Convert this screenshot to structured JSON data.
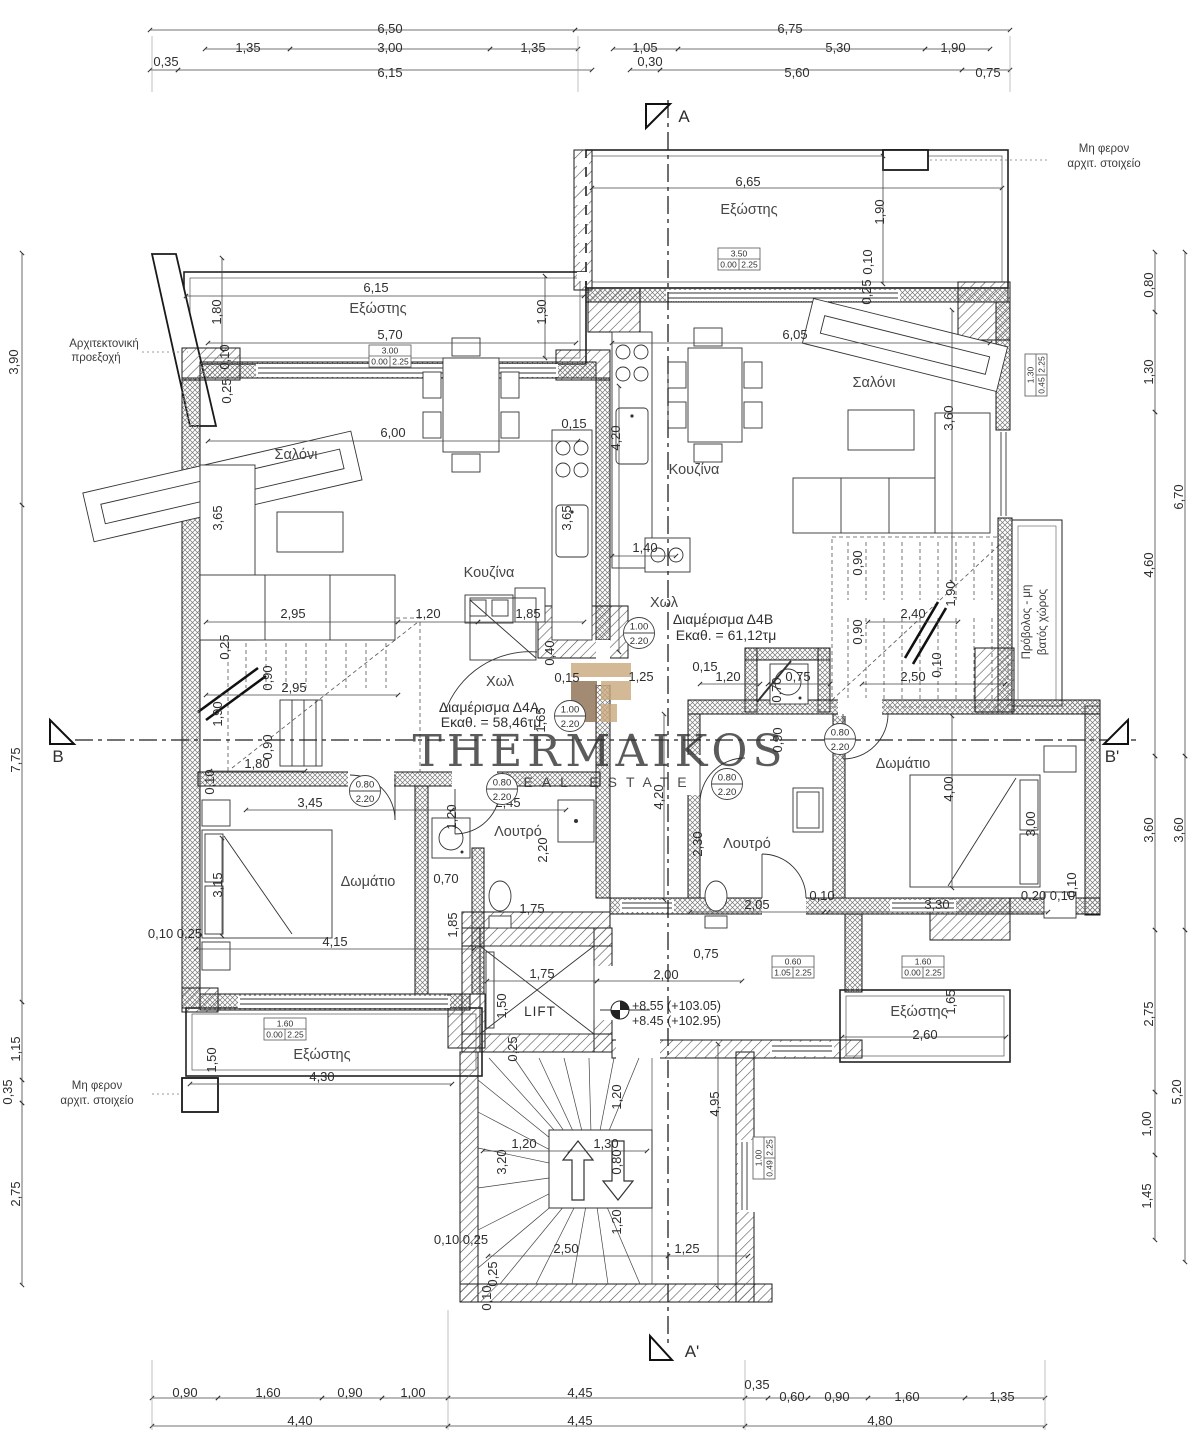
{
  "watermark": {
    "brand": "THERMAIKOS",
    "tagline": "REAL ESTATE"
  },
  "colors": {
    "logo_light": "#c9a87c",
    "logo_dark": "#8d6e50",
    "watermark_text": "#9c9c9c"
  },
  "apartments": [
    {
      "label": "Διαμέρισμα Δ4Α",
      "area": "Εκαθ. = 58,46τμ"
    },
    {
      "label": "Διαμέρισμα Δ4Β",
      "area": "Εκαθ. = 61,12τμ"
    }
  ],
  "elevation": {
    "line1": "+8.55 (+103.05)",
    "line2": "+8.45 (+102.95)"
  },
  "texts": [
    {
      "t": "6,50",
      "x": 390,
      "y": 33
    },
    {
      "t": "6,75",
      "x": 790,
      "y": 33
    },
    {
      "t": "1,35",
      "x": 248,
      "y": 52
    },
    {
      "t": "3,00",
      "x": 390,
      "y": 52
    },
    {
      "t": "1,35",
      "x": 533,
      "y": 52
    },
    {
      "t": "1,05",
      "x": 645,
      "y": 52
    },
    {
      "t": "5,30",
      "x": 838,
      "y": 52
    },
    {
      "t": "1,90",
      "x": 953,
      "y": 52
    },
    {
      "t": "0,35",
      "x": 166,
      "y": 66
    },
    {
      "t": "6,15",
      "x": 390,
      "y": 77
    },
    {
      "t": "0,30",
      "x": 650,
      "y": 66
    },
    {
      "t": "5,60",
      "x": 797,
      "y": 77
    },
    {
      "t": "0,75",
      "x": 988,
      "y": 77
    },
    {
      "t": "Μη φερον",
      "x": 1104,
      "y": 152,
      "k": "note"
    },
    {
      "t": "αρχιτ. στοιχείο",
      "x": 1104,
      "y": 167,
      "k": "note"
    },
    {
      "t": "6,65",
      "x": 748,
      "y": 186
    },
    {
      "t": "Εξώστης",
      "x": 749,
      "y": 214,
      "k": "room"
    },
    {
      "t": "1,90",
      "x": 884,
      "y": 212,
      "r": -90
    },
    {
      "t": "0,10",
      "x": 872,
      "y": 262,
      "r": -90
    },
    {
      "t": "0,25",
      "x": 871,
      "y": 292,
      "r": -90
    },
    {
      "t": "0,80",
      "x": 1153,
      "y": 285,
      "r": -90
    },
    {
      "t": "1,30",
      "x": 1153,
      "y": 372,
      "r": -90
    },
    {
      "t": "4,60",
      "x": 1153,
      "y": 565,
      "r": -90
    },
    {
      "t": "6,70",
      "x": 1183,
      "y": 497,
      "r": -90
    },
    {
      "t": "Αρχιτεκτονική",
      "x": 104,
      "y": 347,
      "k": "note"
    },
    {
      "t": "προεξοχή",
      "x": 96,
      "y": 361,
      "k": "note"
    },
    {
      "t": "3,90",
      "x": 18,
      "y": 362,
      "r": -90
    },
    {
      "t": "7,75",
      "x": 20,
      "y": 760,
      "r": -90
    },
    {
      "t": "1,80",
      "x": 221,
      "y": 312,
      "r": -90
    },
    {
      "t": "0,10",
      "x": 229,
      "y": 357,
      "r": -90
    },
    {
      "t": "0,25",
      "x": 231,
      "y": 391,
      "r": -90
    },
    {
      "t": "6,15",
      "x": 376,
      "y": 292
    },
    {
      "t": "Εξώστης",
      "x": 378,
      "y": 313,
      "k": "room"
    },
    {
      "t": "1,90",
      "x": 546,
      "y": 312,
      "r": -90
    },
    {
      "t": "5,70",
      "x": 390,
      "y": 339
    },
    {
      "t": "6,05",
      "x": 795,
      "y": 339
    },
    {
      "t": "6,00",
      "x": 393,
      "y": 437
    },
    {
      "t": "0,15",
      "x": 574,
      "y": 428
    },
    {
      "t": "4,20",
      "x": 620,
      "y": 438,
      "r": -90
    },
    {
      "t": "Σαλόνι",
      "x": 296,
      "y": 459,
      "k": "room"
    },
    {
      "t": "Σαλόνι",
      "x": 874,
      "y": 387,
      "k": "room"
    },
    {
      "t": "3,60",
      "x": 953,
      "y": 418,
      "r": -90
    },
    {
      "t": "3,65",
      "x": 222,
      "y": 518,
      "r": -90
    },
    {
      "t": "3,65",
      "x": 571,
      "y": 518,
      "r": -90
    },
    {
      "t": "Κουζίνα",
      "x": 489,
      "y": 577,
      "k": "room"
    },
    {
      "t": "Κουζίνα",
      "x": 694,
      "y": 474,
      "k": "room"
    },
    {
      "t": "1,40",
      "x": 645,
      "y": 552
    },
    {
      "t": "2,95",
      "x": 293,
      "y": 618
    },
    {
      "t": "1,20",
      "x": 428,
      "y": 618
    },
    {
      "t": "1,85",
      "x": 528,
      "y": 618
    },
    {
      "t": "0,90",
      "x": 862,
      "y": 563,
      "r": -90
    },
    {
      "t": "1,90",
      "x": 955,
      "y": 594,
      "r": -90
    },
    {
      "t": "2,40",
      "x": 913,
      "y": 618
    },
    {
      "t": "0,90",
      "x": 862,
      "y": 632,
      "r": -90
    },
    {
      "t": "Χωλ",
      "x": 664,
      "y": 607,
      "k": "room"
    },
    {
      "t": "Διαμέρισμα Δ4Β",
      "x": 723,
      "y": 624,
      "k": "apt"
    },
    {
      "t": "Εκαθ. = 61,12τμ",
      "x": 726,
      "y": 640,
      "k": "apt"
    },
    {
      "t": "0,25",
      "x": 229,
      "y": 647,
      "r": -90
    },
    {
      "t": "0,90",
      "x": 272,
      "y": 678,
      "r": -90
    },
    {
      "t": "2,95",
      "x": 294,
      "y": 692
    },
    {
      "t": "1,90",
      "x": 222,
      "y": 714,
      "r": -90
    },
    {
      "t": "0,90",
      "x": 272,
      "y": 747,
      "r": -90
    },
    {
      "t": "1,80",
      "x": 257,
      "y": 768
    },
    {
      "t": "0,10",
      "x": 214,
      "y": 782,
      "r": -90
    },
    {
      "t": "Χωλ",
      "x": 500,
      "y": 686,
      "k": "room"
    },
    {
      "t": "0,40",
      "x": 554,
      "y": 653,
      "r": -90
    },
    {
      "t": "0,15",
      "x": 567,
      "y": 682
    },
    {
      "t": "1,25",
      "x": 641,
      "y": 681
    },
    {
      "t": "1,65",
      "x": 545,
      "y": 720,
      "r": -90
    },
    {
      "t": "Διαμέρισμα Δ4Α",
      "x": 489,
      "y": 712,
      "k": "apt"
    },
    {
      "t": "Εκαθ. = 58,46τμ",
      "x": 491,
      "y": 727,
      "k": "apt"
    },
    {
      "t": "0,15",
      "x": 705,
      "y": 671
    },
    {
      "t": "1,20",
      "x": 728,
      "y": 681
    },
    {
      "t": "0,75",
      "x": 798,
      "y": 681
    },
    {
      "t": "0,70",
      "x": 781,
      "y": 690,
      "r": -90
    },
    {
      "t": "2,50",
      "x": 913,
      "y": 681
    },
    {
      "t": "0,10",
      "x": 941,
      "y": 665,
      "r": -90
    },
    {
      "t": "0,90",
      "x": 782,
      "y": 740,
      "r": -90
    },
    {
      "t": "Δωμάτιο",
      "x": 903,
      "y": 768,
      "k": "room"
    },
    {
      "t": "4,00",
      "x": 953,
      "y": 789,
      "r": -90
    },
    {
      "t": "3,00",
      "x": 1035,
      "y": 824,
      "r": -90
    },
    {
      "t": "2,30",
      "x": 702,
      "y": 844,
      "r": -90
    },
    {
      "t": "Λουτρό",
      "x": 747,
      "y": 848,
      "k": "room"
    },
    {
      "t": "2,05",
      "x": 757,
      "y": 909
    },
    {
      "t": "0,10",
      "x": 822,
      "y": 900
    },
    {
      "t": "3,30",
      "x": 937,
      "y": 909
    },
    {
      "t": "0,20 0,10",
      "x": 1048,
      "y": 900
    },
    {
      "t": "0,10",
      "x": 1076,
      "y": 885,
      "r": -90
    },
    {
      "t": "3,60",
      "x": 1153,
      "y": 830,
      "r": -90
    },
    {
      "t": "3,60",
      "x": 1183,
      "y": 830,
      "r": -90
    },
    {
      "t": "Πρόβολος - μη",
      "x": 1030,
      "y": 622,
      "r": -90,
      "k": "note"
    },
    {
      "t": "βατός χώρος",
      "x": 1046,
      "y": 622,
      "r": -90,
      "k": "note"
    },
    {
      "t": "B",
      "x": 58,
      "y": 762,
      "k": "marker"
    },
    {
      "t": "B'",
      "x": 1112,
      "y": 762,
      "k": "marker"
    },
    {
      "t": "A",
      "x": 684,
      "y": 122,
      "k": "marker"
    },
    {
      "t": "A'",
      "x": 692,
      "y": 1357,
      "k": "marker"
    },
    {
      "t": "3,45",
      "x": 310,
      "y": 807
    },
    {
      "t": "2,45",
      "x": 508,
      "y": 807
    },
    {
      "t": "1,20",
      "x": 456,
      "y": 817,
      "r": -90
    },
    {
      "t": "3,15",
      "x": 222,
      "y": 885,
      "r": -90
    },
    {
      "t": "Δωμάτιο",
      "x": 368,
      "y": 886,
      "k": "room"
    },
    {
      "t": "Λουτρό",
      "x": 518,
      "y": 836,
      "k": "room"
    },
    {
      "t": "2,20",
      "x": 547,
      "y": 850,
      "r": -90
    },
    {
      "t": "0,70",
      "x": 446,
      "y": 883
    },
    {
      "t": "1,75",
      "x": 532,
      "y": 913
    },
    {
      "t": "1,85",
      "x": 457,
      "y": 925,
      "r": -90
    },
    {
      "t": "0,10 0,25",
      "x": 175,
      "y": 938
    },
    {
      "t": "4,15",
      "x": 335,
      "y": 946
    },
    {
      "t": "1,15",
      "x": 20,
      "y": 1049,
      "r": -90
    },
    {
      "t": "0,35",
      "x": 12,
      "y": 1092,
      "r": -90
    },
    {
      "t": "2,75",
      "x": 20,
      "y": 1194,
      "r": -90
    },
    {
      "t": "Μη φερον",
      "x": 97,
      "y": 1089,
      "k": "note"
    },
    {
      "t": "αρχιτ. στοιχείο",
      "x": 97,
      "y": 1104,
      "k": "note"
    },
    {
      "t": "1,50",
      "x": 216,
      "y": 1060,
      "r": -90
    },
    {
      "t": "Εξώστης",
      "x": 322,
      "y": 1059,
      "k": "room"
    },
    {
      "t": "4,30",
      "x": 322,
      "y": 1081
    },
    {
      "t": "1,75",
      "x": 542,
      "y": 978
    },
    {
      "t": "2,00",
      "x": 666,
      "y": 979
    },
    {
      "t": "0,75",
      "x": 706,
      "y": 958
    },
    {
      "t": "1,50",
      "x": 506,
      "y": 1006,
      "r": -90
    },
    {
      "t": "LIFT",
      "x": 540,
      "y": 1016,
      "k": "lift"
    },
    {
      "t": "0,25",
      "x": 517,
      "y": 1049,
      "r": -90
    },
    {
      "t": "1,20",
      "x": 621,
      "y": 1097,
      "r": -90
    },
    {
      "t": "4,95",
      "x": 719,
      "y": 1104,
      "r": -90
    },
    {
      "t": "4,20",
      "x": 663,
      "y": 797,
      "r": -90
    },
    {
      "t": "Εξώστης",
      "x": 919,
      "y": 1016,
      "k": "room"
    },
    {
      "t": "1,65",
      "x": 955,
      "y": 1002,
      "r": -90
    },
    {
      "t": "2,60",
      "x": 925,
      "y": 1039
    },
    {
      "t": "2,75",
      "x": 1153,
      "y": 1014,
      "r": -90
    },
    {
      "t": "5,20",
      "x": 1181,
      "y": 1092,
      "r": -90
    },
    {
      "t": "1,00",
      "x": 1151,
      "y": 1124,
      "r": -90
    },
    {
      "t": "1,45",
      "x": 1151,
      "y": 1196,
      "r": -90
    },
    {
      "t": "1,20",
      "x": 524,
      "y": 1148
    },
    {
      "t": "3,20",
      "x": 506,
      "y": 1162,
      "r": -90
    },
    {
      "t": "1,30",
      "x": 606,
      "y": 1148
    },
    {
      "t": "0,80",
      "x": 621,
      "y": 1162,
      "r": -90
    },
    {
      "t": "1,20",
      "x": 621,
      "y": 1222,
      "r": -90
    },
    {
      "t": "2,50",
      "x": 566,
      "y": 1253
    },
    {
      "t": "1,25",
      "x": 687,
      "y": 1253
    },
    {
      "t": "0,10 0,25",
      "x": 461,
      "y": 1244
    },
    {
      "t": "0,25",
      "x": 497,
      "y": 1274,
      "r": -90
    },
    {
      "t": "0,10",
      "x": 491,
      "y": 1298,
      "r": -90
    },
    {
      "t": "0,90",
      "x": 185,
      "y": 1397
    },
    {
      "t": "1,60",
      "x": 268,
      "y": 1397
    },
    {
      "t": "0,90",
      "x": 350,
      "y": 1397
    },
    {
      "t": "1,00",
      "x": 413,
      "y": 1397
    },
    {
      "t": "4,45",
      "x": 580,
      "y": 1397
    },
    {
      "t": "0,35",
      "x": 757,
      "y": 1389
    },
    {
      "t": "0,60",
      "x": 792,
      "y": 1401
    },
    {
      "t": "0,90",
      "x": 837,
      "y": 1401
    },
    {
      "t": "1,60",
      "x": 907,
      "y": 1401
    },
    {
      "t": "1,35",
      "x": 1002,
      "y": 1401
    },
    {
      "t": "4,40",
      "x": 300,
      "y": 1425
    },
    {
      "t": "4,45",
      "x": 580,
      "y": 1425
    },
    {
      "t": "4,80",
      "x": 880,
      "y": 1425
    },
    {
      "t": "THERMAIKOS",
      "x": 600,
      "y": 766,
      "k": "wm1"
    },
    {
      "t": "REAL ESTATE",
      "x": 600,
      "y": 787,
      "k": "wm2"
    },
    {
      "t": "+8.55 (+103.05)",
      "x": 632,
      "y": 1010,
      "k": "elev"
    },
    {
      "t": "+8.45 (+102.95)",
      "x": 632,
      "y": 1025,
      "k": "elev"
    }
  ],
  "door_tags": [
    {
      "a": "1.00",
      "b": "2.20",
      "x": 639,
      "y": 633
    },
    {
      "a": "1.00",
      "b": "2.20",
      "x": 570,
      "y": 716
    },
    {
      "a": "0.80",
      "b": "2.20",
      "x": 502,
      "y": 789
    },
    {
      "a": "0.80",
      "b": "2.20",
      "x": 365,
      "y": 791
    },
    {
      "a": "0.80",
      "b": "2.20",
      "x": 727,
      "y": 784
    },
    {
      "a": "0.80",
      "b": "2.20",
      "x": 840,
      "y": 739
    }
  ],
  "window_tags": [
    {
      "a": "3.00",
      "b": "0.00",
      "c": "2.25",
      "x": 390,
      "y": 356
    },
    {
      "a": "3.50",
      "b": "0.00",
      "c": "2.25",
      "x": 739,
      "y": 259
    },
    {
      "a": "1.60",
      "b": "0.00",
      "c": "2.25",
      "x": 285,
      "y": 1029
    },
    {
      "a": "0.60",
      "b": "1.05",
      "c": "2.25",
      "x": 793,
      "y": 967
    },
    {
      "a": "1.60",
      "b": "0.00",
      "c": "2.25",
      "x": 923,
      "y": 967
    },
    {
      "a": "1.30",
      "b": "0.45",
      "c": "2.25",
      "x": 1036,
      "y": 375,
      "r": -90
    },
    {
      "a": "1.00",
      "b": "0.49",
      "c": "2.25",
      "x": 764,
      "y": 1158,
      "r": -90
    }
  ]
}
